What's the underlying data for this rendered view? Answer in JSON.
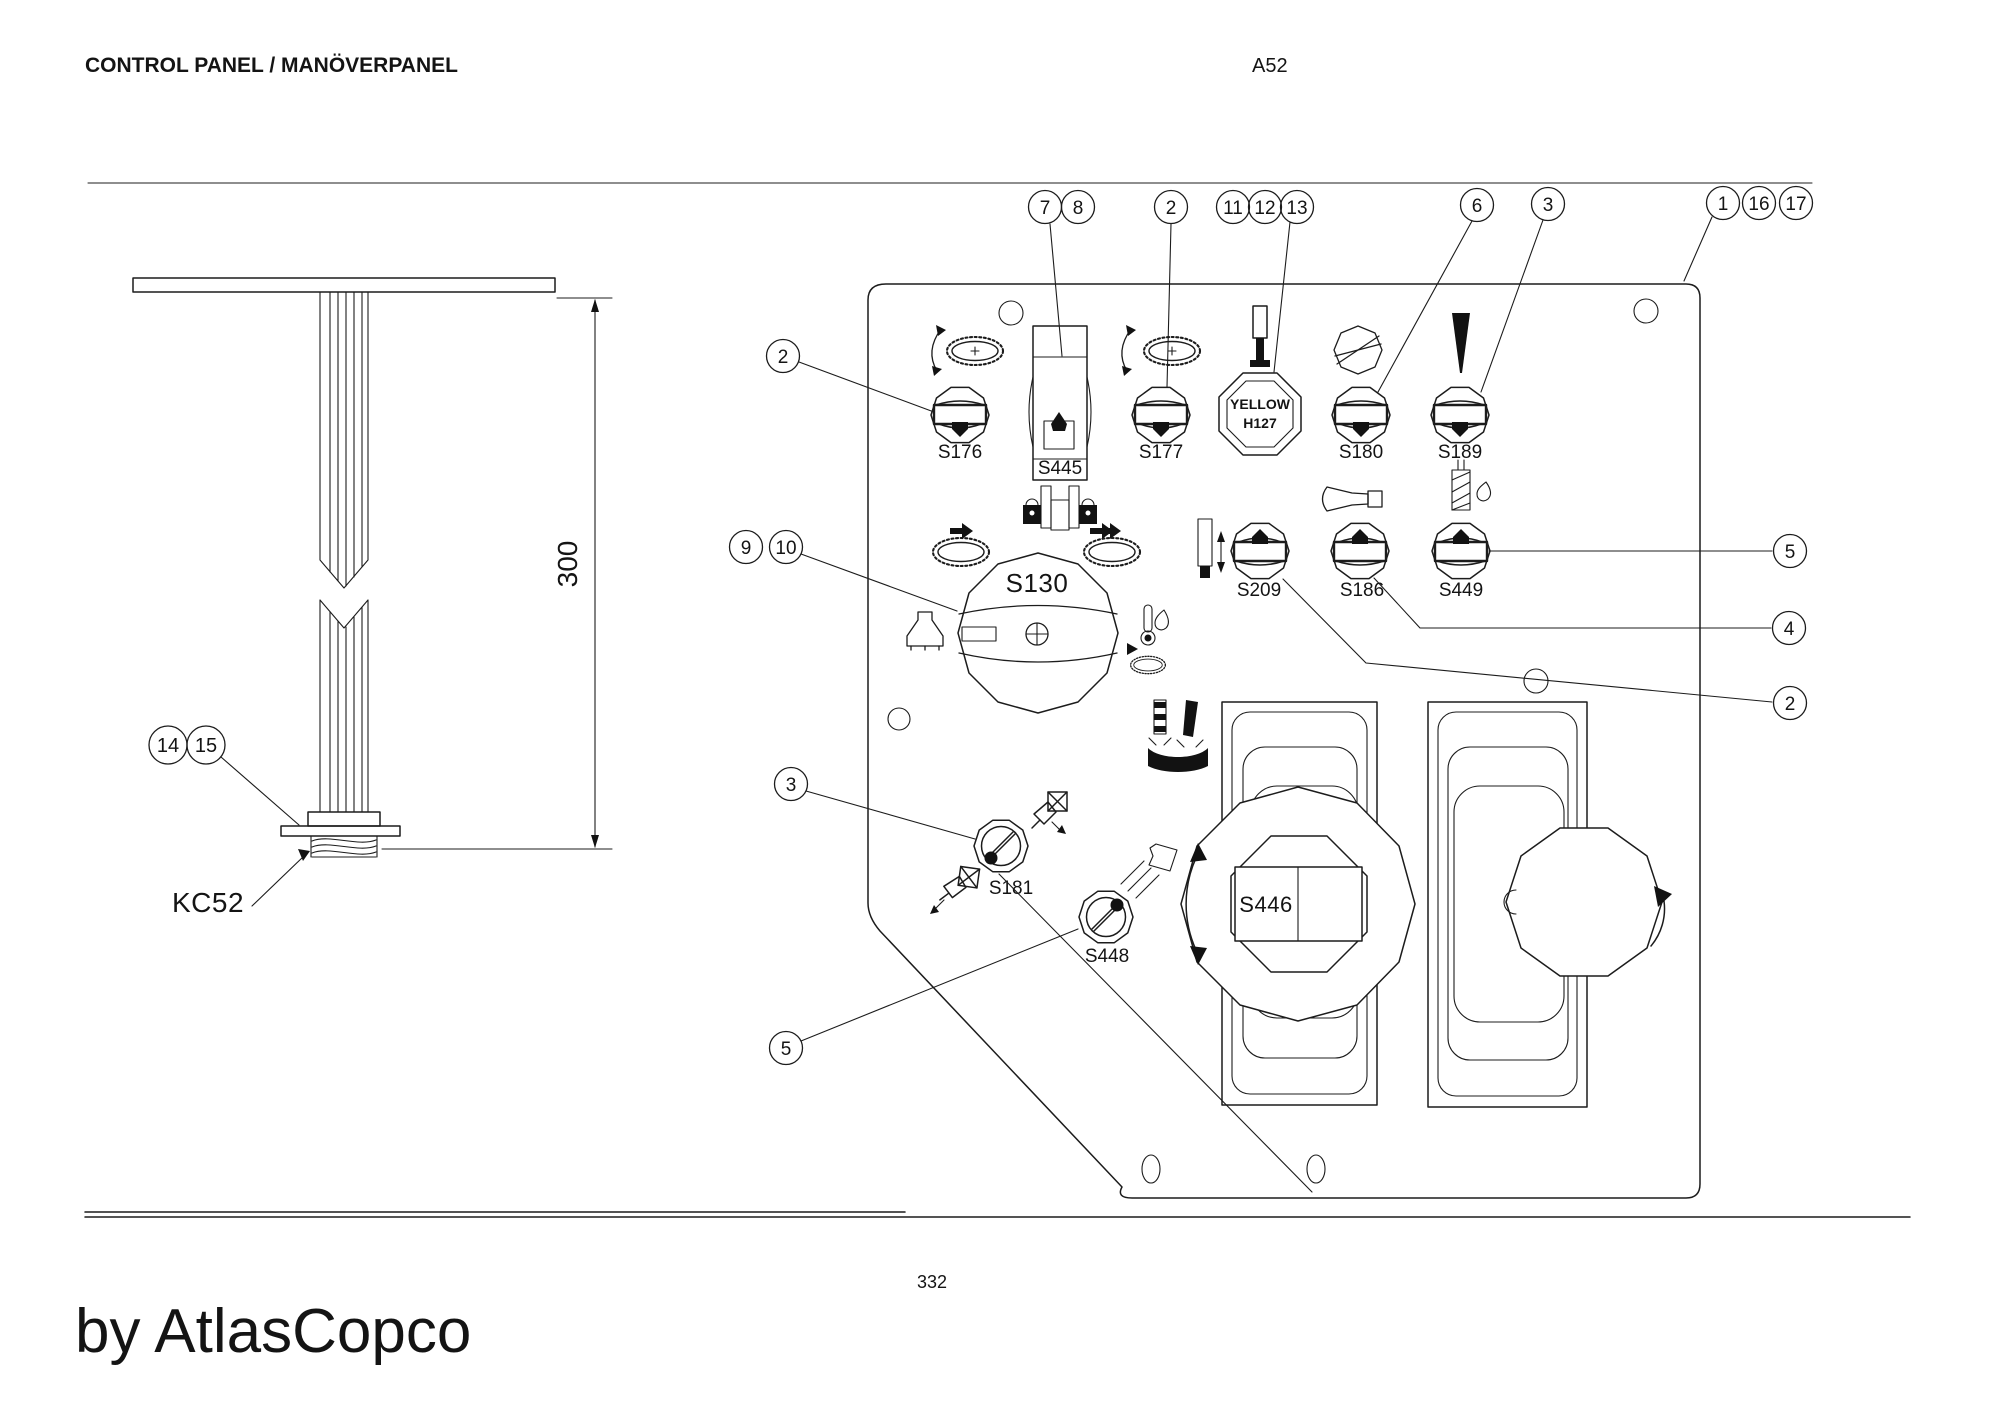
{
  "header": {
    "title": "CONTROL PANEL / MANÖVERPANEL",
    "code": "A52"
  },
  "footer": {
    "page_number": "332",
    "brand": "by AtlasCopco"
  },
  "left_view": {
    "dimension": "300",
    "part_ref": "KC52"
  },
  "controls": {
    "s176": "S176",
    "s445": "S445",
    "s177": "S177",
    "h127_color": "YELLOW",
    "h127_id": "H127",
    "s180": "S180",
    "s189": "S189",
    "s209": "S209",
    "s186": "S186",
    "s449": "S449",
    "s130": "S130",
    "s181": "S181",
    "s448": "S448",
    "s446": "S446"
  },
  "balloons": {
    "b7": "7",
    "b8": "8",
    "b2_top": "2",
    "b11": "11",
    "b12": "12",
    "b13": "13",
    "b6": "6",
    "b3_top": "3",
    "b1": "1",
    "b16": "16",
    "b17": "17",
    "b2_left": "2",
    "b9": "9",
    "b10": "10",
    "b3_left": "3",
    "b5_left": "5",
    "b14": "14",
    "b15": "15",
    "b5_right": "5",
    "b4": "4",
    "b2_right": "2"
  }
}
